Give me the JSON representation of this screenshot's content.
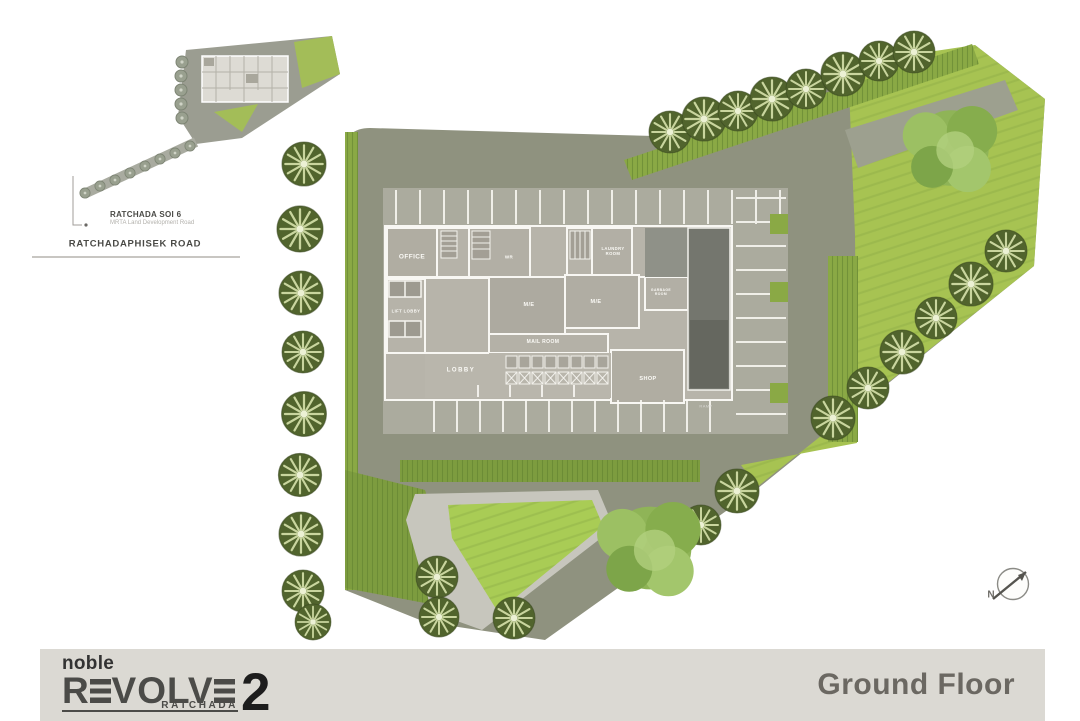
{
  "colors": {
    "paving": "#8f927f",
    "paving-light": "#9da08f",
    "apron": "#abab9e",
    "slab": "#b7b4aa",
    "wall": "#f8f7f3",
    "lawn": "#a7c352",
    "lawn-bright": "#a9cc55",
    "hedge": "#8aa945",
    "hedge-dark": "#7d9c3f",
    "tree-dark": "#51642d",
    "tree-vein": "#d6e2ab",
    "tree-fluffy": "#8fb457",
    "path": "#c7c6bd",
    "ramp": "#74766e",
    "ramp-dark": "#65675f",
    "footer-bg": "#dbd9d3",
    "footer-text": "#6b6862",
    "logo-gray": "#4b4b48",
    "logo-dark": "#1d1d1d",
    "ink": "#4a4a46",
    "subtle": "#b3b1ac"
  },
  "footer": {
    "floor_label": "Ground Floor",
    "logo": {
      "brand": "noble",
      "name": "REVOLVE",
      "number": "2",
      "sub": "RATCHADA"
    }
  },
  "inset": {
    "soi_label": "RATCHADA SOI 6",
    "soi_sublabel": "MRTA Land Development Road",
    "road_label": "RATCHADAPHISEK ROAD"
  },
  "compass": {
    "north": "N"
  },
  "plan": {
    "rooms": {
      "office": "OFFICE",
      "lift_lobby": "LIFT LOBBY",
      "wr": "WR",
      "laundry_room": "LAUNDRY ROOM",
      "me_center": "M/E",
      "me_right": "M/E",
      "mail_room": "MAIL ROOM",
      "garbage": "GARBAGE ROOM",
      "lobby": "LOBBY",
      "shop": "SHOP",
      "ramp": "RAMP"
    }
  }
}
